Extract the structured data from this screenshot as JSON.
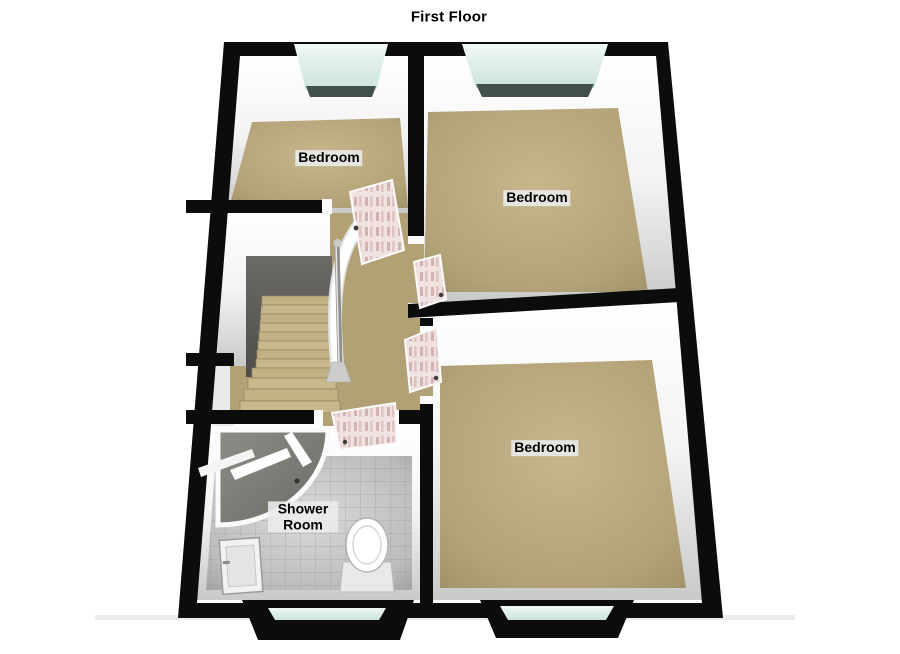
{
  "title": "First Floor",
  "rooms": [
    {
      "label": "Bedroom"
    },
    {
      "label": "Bedroom"
    },
    {
      "label": "Bedroom"
    },
    {
      "label": "Shower Room"
    }
  ],
  "fixtures": [
    "staircase-with-handrail",
    "corner-shower-enclosure",
    "toilet",
    "basin",
    "door",
    "door",
    "door",
    "door",
    "window",
    "window",
    "window",
    "window"
  ],
  "colors": {
    "background": "#ffffff",
    "wall": "#0c0c0c",
    "wall_face": "#f2f2f2",
    "bedroom_floor": "#b5a478",
    "tile_floor": "#c2c2c2",
    "window_glass": "#d6ebe3",
    "window_sill": "#42524b",
    "stair_void": "#5c5b57",
    "stair_steps": "#c2b184",
    "door_face": "#ecdcda",
    "door_panel": "#d3b3b1",
    "label_background": "#ececec",
    "label_text": "#000000"
  }
}
